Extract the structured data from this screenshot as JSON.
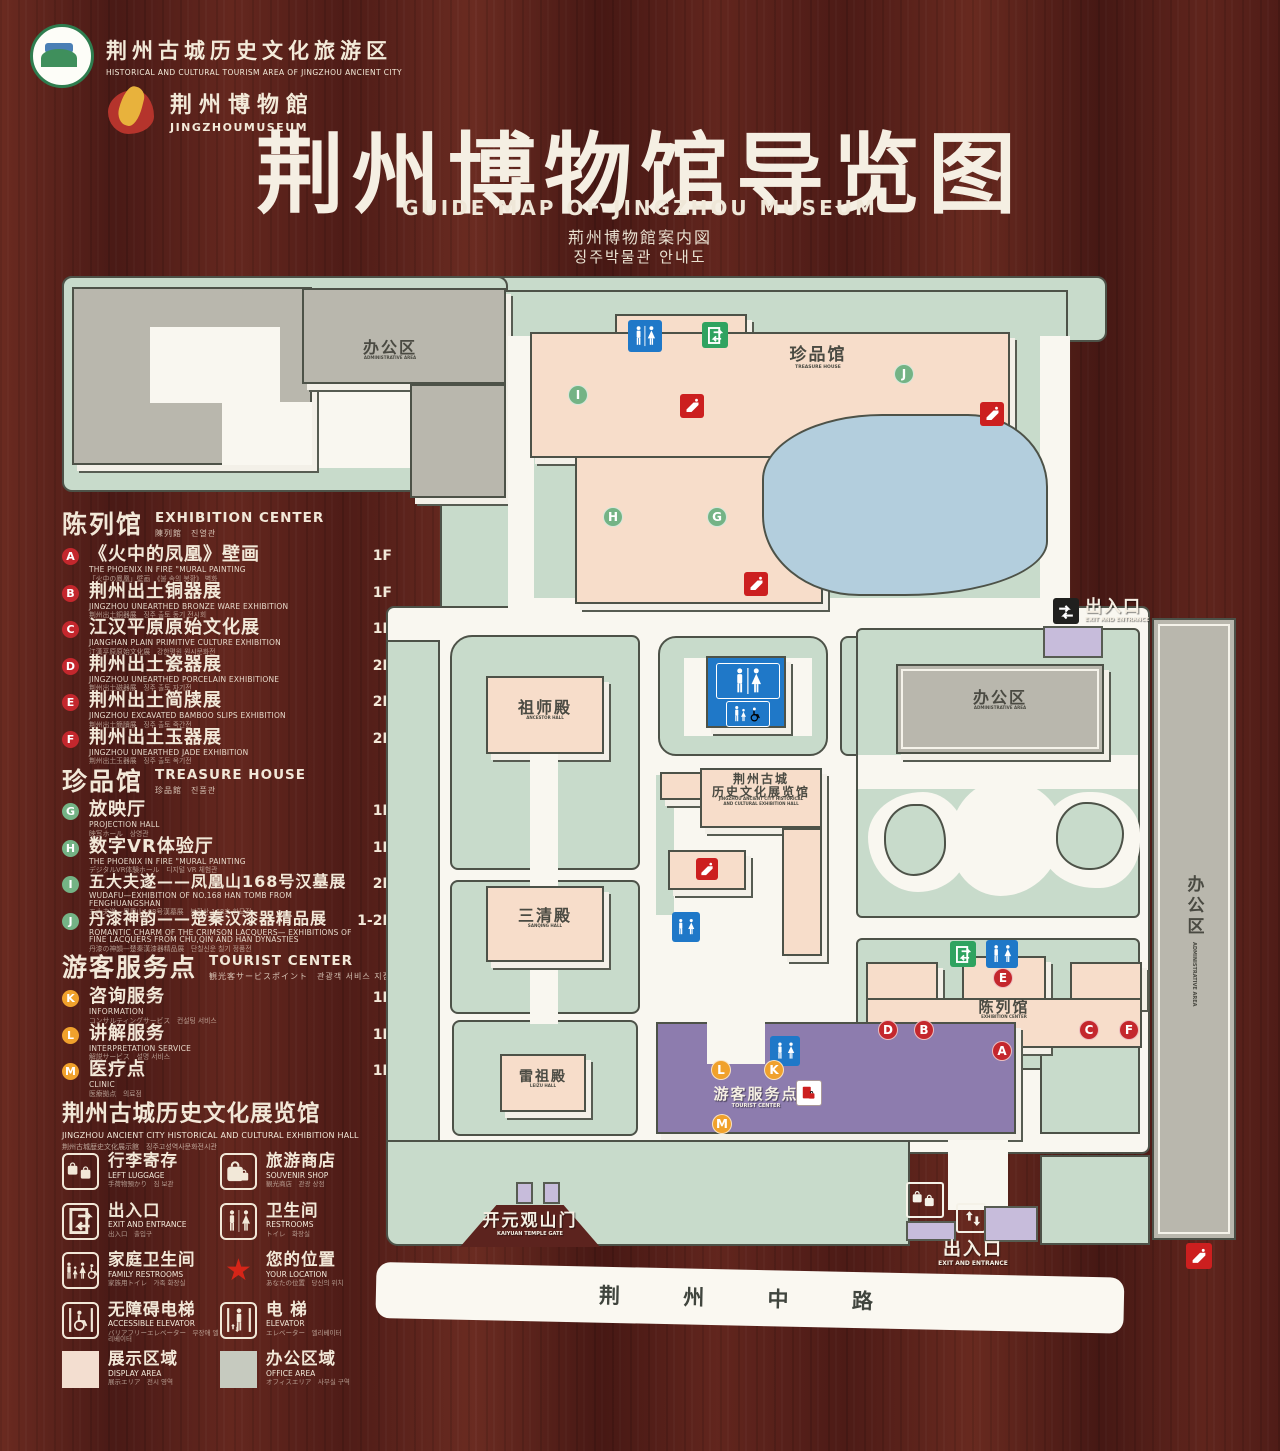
{
  "header": {
    "logo1_zh": "荆州古城历史文化旅游区",
    "logo1_en": "HISTORICAL AND CULTURAL TOURISM AREA OF JINGZHOU ANCIENT CITY",
    "logo2_zh": "荆州博物館",
    "logo2_en": "JINGZHOUMUSEUM",
    "title_zh": "荆州博物馆导览图",
    "title_en": "GUIDE MAP OF JINGZHOU MUSEUM",
    "title_ja": "荊州博物館案内図",
    "title_ko": "징주박물관 안내도"
  },
  "legend": {
    "sections": [
      {
        "title_zh": "陈列馆",
        "title_en": "EXHIBITION CENTER",
        "title_sub": "陳列館　진열관",
        "items": [
          {
            "letter": "A",
            "zh": "《火中的凤凰》壁画",
            "en": "THE PHOENIX IN FIRE \"MURAL PAINTING",
            "jk": "「火中の鳳凰」壁画　《불 속의 봉황》 벽화",
            "floor": "1F"
          },
          {
            "letter": "B",
            "zh": "荆州出土铜器展",
            "en": "JINGZHOU UNEARTHED BRONZE WARE EXHIBITION",
            "jk": "荆州出土銅器展　징주 출토 동기 전시회",
            "floor": "1F"
          },
          {
            "letter": "C",
            "zh": "江汉平原原始文化展",
            "en": "JIANGHAN PLAIN PRIMITIVE CULTURE EXHIBITION",
            "jk": "江漢平原原始文化展　강한평원 원시문화전",
            "floor": "1F"
          },
          {
            "letter": "D",
            "zh": "荆州出土瓷器展",
            "en": "JINGZHOU UNEARTHED PORCELAIN EXHIBITIONE",
            "jk": "荆州出土磁器展　징주 출토 자기전",
            "floor": "2F"
          },
          {
            "letter": "E",
            "zh": "荆州出土简牍展",
            "en": "JINGZHOU EXCAVATED BAMBOO SLIPS EXHIBITION",
            "jk": "荆州出土簡牘展　징주 출토 죽간전",
            "floor": "2F"
          },
          {
            "letter": "F",
            "zh": "荆州出土玉器展",
            "en": "JINGZHOU UNEARTHED JADE EXHIBITION",
            "jk": "荆州出土玉器展　징주 출토 옥기전",
            "floor": "2F"
          }
        ]
      },
      {
        "title_zh": "珍品馆",
        "title_en": "TREASURE HOUSE",
        "title_sub": "珍品館　진품관",
        "items": [
          {
            "letter": "G",
            "zh": "放映厅",
            "en": "PROJECTION HALL",
            "jk": "映写ホール　상영관",
            "floor": "1F"
          },
          {
            "letter": "H",
            "zh": "数字VR体验厅",
            "en": "THE PHOENIX IN FIRE \"MURAL PAINTING",
            "jk": "デジタルVR体験ホール　디지털 VR 체험관",
            "floor": "1F"
          },
          {
            "letter": "I",
            "zh": "五大夫遂——凤凰山168号汉墓展",
            "en": "WUDAFU—EXHIBITION OF NO.168 HAN TOMB FROM FENGHUANGSHAN",
            "jk": "五大夫遂—鳳凰山168号漢墓展　봉황산 168호 한묘전",
            "floor": "2F"
          },
          {
            "letter": "J",
            "zh": "丹漆神韵——楚秦汉漆器精品展",
            "en": "ROMANTIC CHARM OF THE CRIMSON LACQUERS— EXHIBITIONS OF FINE LACQUERS FROM CHU,QIN AND HAN DYNASTIES",
            "jk": "丹漆の神韻—楚秦漢漆器精品展　단칠신운 칠기 정품전",
            "floor": "1-2F"
          }
        ]
      },
      {
        "title_zh": "游客服务点",
        "title_en": "TOURIST CENTER",
        "title_sub": "観光客サービスポイント　관광객 서비스 지점",
        "items": [
          {
            "letter": "K",
            "zh": "咨询服务",
            "en": "INFORMATION",
            "jk": "コンサルティングサービス　컨설팅 서비스",
            "floor": "1F"
          },
          {
            "letter": "L",
            "zh": "讲解服务",
            "en": "INTERPRETATION SERVICE",
            "jk": "解説サービス　설명 서비스",
            "floor": "1F"
          },
          {
            "letter": "M",
            "zh": "医疗点",
            "en": "CLINIC",
            "jk": "医療拠点　의료점",
            "floor": "1F"
          }
        ]
      }
    ],
    "hall_note": {
      "zh": "荆州古城历史文化展览馆",
      "en": "JINGZHOU ANCIENT CITY HISTORICAL AND CULTURAL EXHIBITION HALL",
      "jk": "荆州古城歴史文化展示館　징주고성역사문화전시관"
    },
    "facilities": [
      {
        "zh": "行李寄存",
        "en": "LEFT LUGGAGE",
        "jk": "手荷物預かり　짐 보관"
      },
      {
        "zh": "旅游商店",
        "en": "SOUVENIR SHOP",
        "jk": "観光商店　관광 상점"
      },
      {
        "zh": "出入口",
        "en": "EXIT AND ENTRANCE",
        "jk": "出入口　출입구"
      },
      {
        "zh": "卫生间",
        "en": "RESTROOMS",
        "jk": "トイレ　화장실"
      },
      {
        "zh": "家庭卫生间",
        "en": "FAMILY RESTROOMS",
        "jk": "家族用トイレ　가족 화장실"
      },
      {
        "zh": "您的位置",
        "en": "YOUR LOCATION",
        "jk": "あなたの位置　당신의 위치"
      },
      {
        "zh": "无障碍电梯",
        "en": "ACCESSIBLE ELEVATOR",
        "jk": "バリアフリーエレベーター　무장애 엘리베이터"
      },
      {
        "zh": "电  梯",
        "en": "ELEVATOR",
        "jk": "エレベーター　엘리베이터"
      },
      {
        "zh": "展示区域",
        "en": "DISPLAY AREA",
        "jk": "展示エリア　전시 영역"
      },
      {
        "zh": "办公区域",
        "en": "OFFICE AREA",
        "jk": "オフィスエリア　사무실 구역"
      }
    ]
  },
  "map": {
    "labels": {
      "office_tl_zh": "办公区",
      "office_tl_en": "ADMINISTRATIVE AREA",
      "treasure_zh": "珍品馆",
      "treasure_en": "TREASURE HOUSE",
      "ancestor_zh": "祖师殿",
      "ancestor_en": "ANCESTOR HALL",
      "sanqing_zh": "三清殿",
      "sanqing_en": "SANQING HALL",
      "leizu_zh": "雷祖殿",
      "leizu_en": "LEIZU HALL",
      "exhhall_zh1": "荆州古城",
      "exhhall_zh2": "历史文化展览馆",
      "exhhall_en1": "JINGZHOU ANCIENT CITY HISTORICAL",
      "exhhall_en2": "AND CULTURAL EXHIBITION HALL",
      "office_r_zh": "办公区",
      "office_r_en": "ADMINISTRATIVE AREA",
      "office_strip_zh": "办公区",
      "office_strip_en": "ADMINISTRATIVE AREA",
      "excenter_zh": "陈列馆",
      "excenter_en": "EXHIBITION CENTER",
      "tourist_zh": "游客服务点",
      "tourist_en": "TOURIST CENTER",
      "gate_zh": "开元观山门",
      "gate_en": "KAIYUAN TEMPLE GATE",
      "exit_zh": "出入口",
      "exit_en": "EXIT AND ENTRANCE",
      "road_zh": "荆 州 中 路",
      "location_zh": "您的位置"
    },
    "badges_green": [
      "I",
      "H",
      "G",
      "J"
    ],
    "badges_red": [
      "E",
      "D",
      "B",
      "A",
      "C",
      "F"
    ],
    "badges_orange": [
      "L",
      "K",
      "M"
    ]
  },
  "colors": {
    "accent_red": "#c4272d",
    "badge_green": "#74b385",
    "badge_orange": "#f0a12c",
    "campus_green": "#c8dbcb",
    "building_pink": "#f7ddca",
    "lake_blue": "#b3cedd",
    "tourist_purple": "#8d7cae",
    "sign_blue": "#1f78c8",
    "sign_green": "#2fa360"
  }
}
